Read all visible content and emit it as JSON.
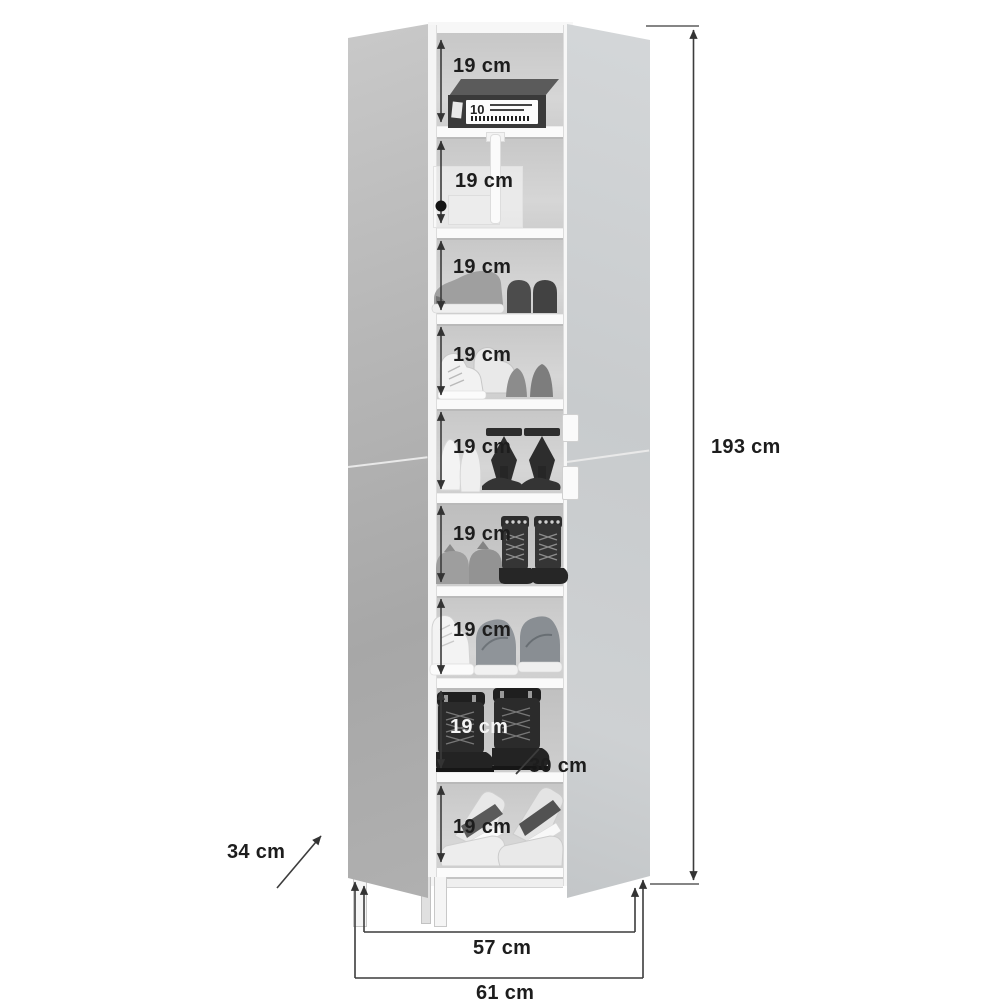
{
  "shelves": [
    {
      "label": "19 cm",
      "contents": "shoe-box-dark"
    },
    {
      "label": "19 cm",
      "contents": "shoe-box-translucent"
    },
    {
      "label": "19 cm",
      "contents": "sneaker-and-loafers"
    },
    {
      "label": "19 cm",
      "contents": "high-top-sneakers-and-flats"
    },
    {
      "label": "19 cm",
      "contents": "white-heels-and-black-stilettos"
    },
    {
      "label": "19 cm",
      "contents": "grey-flats-and-studded-boots"
    },
    {
      "label": "19 cm",
      "contents": "high-top-and-running-shoes"
    },
    {
      "label": "19 cm",
      "contents": "black-lace-up-boots"
    },
    {
      "label": "19 cm",
      "contents": "wedge-sandals"
    }
  ],
  "dimensions": {
    "total_height": "193 cm",
    "inner_width": "57 cm",
    "total_width": "61 cm",
    "door_depth": "34 cm",
    "shelf_depth": "30 cm"
  },
  "shoe_box": {
    "number": "10"
  },
  "colors": {
    "background": "#ffffff",
    "mirror_door_left": "#aeaeae",
    "mirror_door_right": "#cdd0d2",
    "interior_back": "#d2d2d2",
    "dimension_line": "#3c3c3c",
    "label_text": "#1d1d1d",
    "label_text_light": "#f4f4f4"
  }
}
